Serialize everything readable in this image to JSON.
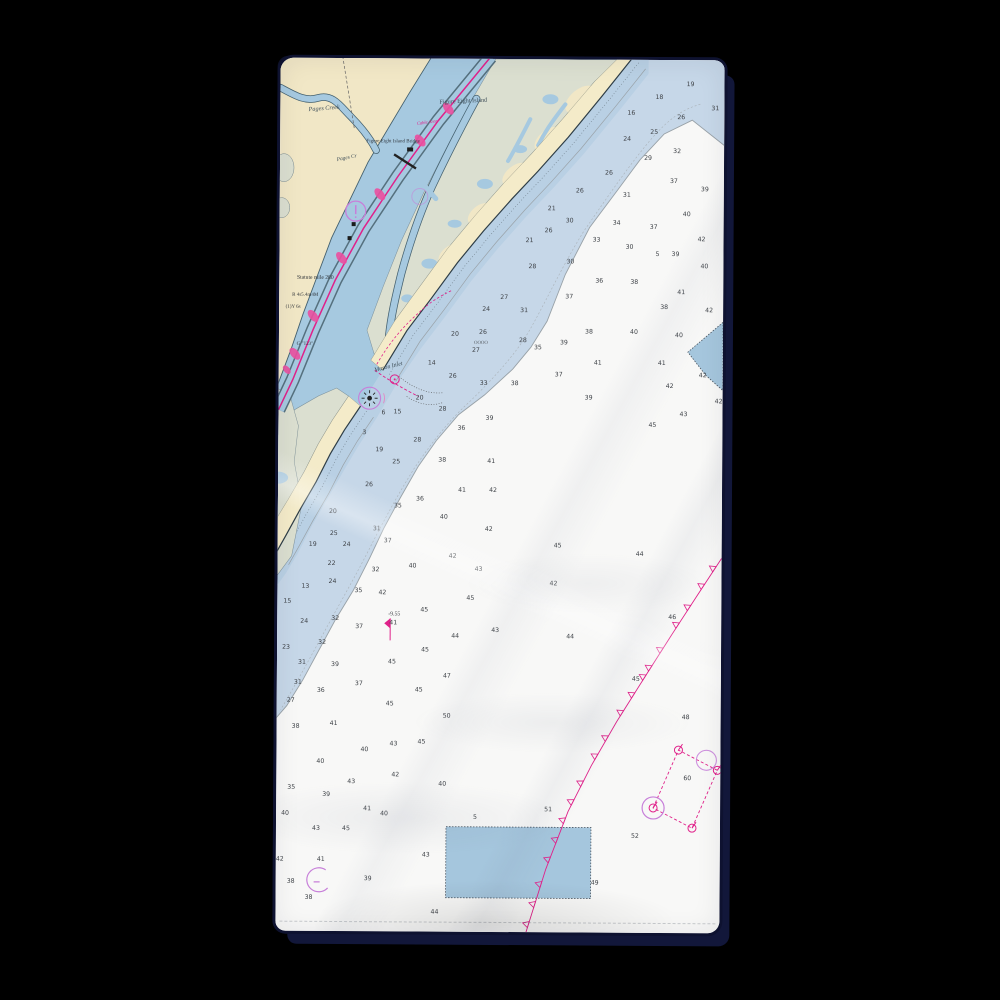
{
  "scene": {
    "type": "product-photo-of-beach-towel-with-nautical-chart-print",
    "background_color": "#000000",
    "towel_color": "#f7f7f8",
    "shadow_color": "#12173a"
  },
  "chart": {
    "colors": {
      "land_tan": "#f1e7c6",
      "beach": "#f4ebc9",
      "marsh_green": "#dbdfd0",
      "channel_blue": "#a6c9e0",
      "shoal_band": "#b9d0e4",
      "nearshore_band": "#c6d7e8",
      "offshore_white": "#f8f8f7",
      "shoreline_dark": "#2e3d46",
      "contour_gray": "#98a1a7",
      "icw_magenta": "#e0218a",
      "caution_purple": "#c77fd9",
      "sounding_text": "#3f4348",
      "disposal_blue": "#a5c6dd"
    },
    "place_labels": [
      {
        "t": "Pages Creek",
        "x": 44,
        "y": 52,
        "s": 6.2,
        "c": "#3e4e58",
        "r": -5,
        "i": 1
      },
      {
        "t": "Figure Eight Island",
        "x": 183,
        "y": 44,
        "s": 6.2,
        "c": "#3e4e58",
        "r": -3,
        "i": 0
      },
      {
        "t": "Figure Eight Island Bridge",
        "x": 113,
        "y": 84,
        "s": 5.0,
        "c": "#333940",
        "r": 0,
        "i": 0
      },
      {
        "t": "Cable Area",
        "x": 147,
        "y": 65,
        "s": 4.6,
        "c": "#e0218a",
        "r": -8,
        "i": 1
      },
      {
        "t": "Pages Cr",
        "x": 67,
        "y": 101,
        "s": 5.4,
        "c": "#3e4e58",
        "r": -12,
        "i": 1
      },
      {
        "t": "Mason Inlet",
        "x": 110,
        "y": 310,
        "s": 6.0,
        "c": "#3e4e58",
        "r": -14,
        "i": 1
      },
      {
        "t": "Statute mile 280",
        "x": 36,
        "y": 221,
        "s": 5.6,
        "c": "#2f3338",
        "r": 0,
        "i": 0
      },
      {
        "t": "R 4s5.4m4M",
        "x": 26,
        "y": 238,
        "s": 5.0,
        "c": "#2f3338",
        "r": 0,
        "i": 0
      },
      {
        "t": "(1)Y 6s",
        "x": 14,
        "y": 250,
        "s": 5.0,
        "c": "#2f3338",
        "r": 0,
        "i": 0
      },
      {
        "t": "G \"123\"",
        "x": 26,
        "y": 287,
        "s": 5.0,
        "c": "#2f3338",
        "r": 0,
        "i": 0
      },
      {
        "t": "-9.55",
        "x": 117,
        "y": 557,
        "s": 5.8,
        "c": "#3f4348",
        "r": 0,
        "i": 0
      },
      {
        "t": "OOOO",
        "x": 202,
        "y": 285,
        "s": 4.8,
        "c": "#555b60",
        "r": 0,
        "i": 0
      }
    ],
    "soundings": [
      [
        410,
        26,
        "19"
      ],
      [
        379,
        39,
        "18"
      ],
      [
        435,
        50,
        "31"
      ],
      [
        351,
        55,
        "16"
      ],
      [
        401,
        59,
        "26"
      ],
      [
        374,
        74,
        "25"
      ],
      [
        347,
        81,
        "24"
      ],
      [
        397,
        93,
        "32"
      ],
      [
        368,
        100,
        "29"
      ],
      [
        329,
        115,
        "26"
      ],
      [
        394,
        123,
        "37"
      ],
      [
        425,
        131,
        "39"
      ],
      [
        300,
        133,
        "26"
      ],
      [
        347,
        137,
        "31"
      ],
      [
        272,
        151,
        "21"
      ],
      [
        407,
        156,
        "40"
      ],
      [
        290,
        163,
        "30"
      ],
      [
        337,
        165,
        "34"
      ],
      [
        374,
        169,
        "37"
      ],
      [
        269,
        173,
        "26"
      ],
      [
        317,
        182,
        "33"
      ],
      [
        250,
        183,
        "21"
      ],
      [
        422,
        181,
        "42"
      ],
      [
        350,
        189,
        "30"
      ],
      [
        378,
        196,
        "5"
      ],
      [
        396,
        196,
        "39"
      ],
      [
        291,
        204,
        "30"
      ],
      [
        253,
        209,
        "28"
      ],
      [
        425,
        208,
        "40"
      ],
      [
        320,
        223,
        "36"
      ],
      [
        355,
        224,
        "38"
      ],
      [
        402,
        234,
        "41"
      ],
      [
        290,
        239,
        "37"
      ],
      [
        225,
        240,
        "27"
      ],
      [
        385,
        249,
        "38"
      ],
      [
        430,
        252,
        "42"
      ],
      [
        207,
        252,
        "24"
      ],
      [
        245,
        253,
        "31"
      ],
      [
        176,
        277,
        "20"
      ],
      [
        204,
        275,
        "26"
      ],
      [
        310,
        274,
        "38"
      ],
      [
        355,
        274,
        "40"
      ],
      [
        400,
        277,
        "40"
      ],
      [
        244,
        283,
        "28"
      ],
      [
        285,
        285,
        "39"
      ],
      [
        259,
        290,
        "35"
      ],
      [
        197,
        293,
        "27"
      ],
      [
        319,
        305,
        "41"
      ],
      [
        153,
        306,
        "14"
      ],
      [
        174,
        319,
        "26"
      ],
      [
        205,
        326,
        "33"
      ],
      [
        280,
        317,
        "37"
      ],
      [
        236,
        326,
        "38"
      ],
      [
        383,
        305,
        "41"
      ],
      [
        424,
        317,
        "42"
      ],
      [
        391,
        328,
        "42"
      ],
      [
        141,
        341,
        "20"
      ],
      [
        310,
        340,
        "39"
      ],
      [
        440,
        343,
        "42"
      ],
      [
        164,
        352,
        "28"
      ],
      [
        119,
        355,
        "15"
      ],
      [
        105,
        356,
        "6"
      ],
      [
        211,
        361,
        "39"
      ],
      [
        183,
        371,
        "36"
      ],
      [
        405,
        356,
        "43"
      ],
      [
        374,
        367,
        "45"
      ],
      [
        86,
        376,
        "3"
      ],
      [
        139,
        383,
        "28"
      ],
      [
        101,
        393,
        "19"
      ],
      [
        118,
        405,
        "25"
      ],
      [
        164,
        403,
        "38"
      ],
      [
        213,
        404,
        "41"
      ],
      [
        91,
        428,
        "26"
      ],
      [
        184,
        433,
        "41"
      ],
      [
        215,
        433,
        "42"
      ],
      [
        142,
        442,
        "36"
      ],
      [
        120,
        449,
        "35"
      ],
      [
        55,
        455,
        "20"
      ],
      [
        166,
        460,
        "40"
      ],
      [
        56,
        477,
        "25"
      ],
      [
        99,
        472,
        "31"
      ],
      [
        211,
        472,
        "42"
      ],
      [
        69,
        488,
        "24"
      ],
      [
        110,
        484,
        "37"
      ],
      [
        35,
        488,
        "19"
      ],
      [
        280,
        488,
        "45"
      ],
      [
        175,
        499,
        "42"
      ],
      [
        362,
        496,
        "44"
      ],
      [
        54,
        507,
        "22"
      ],
      [
        135,
        509,
        "40"
      ],
      [
        201,
        512,
        "43"
      ],
      [
        98,
        513,
        "32"
      ],
      [
        276,
        526,
        "42"
      ],
      [
        55,
        525,
        "24"
      ],
      [
        28,
        530,
        "13"
      ],
      [
        81,
        534,
        "35"
      ],
      [
        105,
        536,
        "42"
      ],
      [
        193,
        541,
        "45"
      ],
      [
        10,
        545,
        "15"
      ],
      [
        147,
        553,
        "45"
      ],
      [
        395,
        559,
        "46"
      ],
      [
        116,
        566,
        "41"
      ],
      [
        27,
        565,
        "24"
      ],
      [
        58,
        562,
        "32"
      ],
      [
        82,
        570,
        "37"
      ],
      [
        178,
        579,
        "44"
      ],
      [
        218,
        573,
        "43"
      ],
      [
        45,
        586,
        "32"
      ],
      [
        9,
        591,
        "23"
      ],
      [
        148,
        593,
        "45"
      ],
      [
        293,
        579,
        "44"
      ],
      [
        25,
        606,
        "31"
      ],
      [
        115,
        605,
        "45"
      ],
      [
        58,
        608,
        "39"
      ],
      [
        359,
        621,
        "45"
      ],
      [
        170,
        619,
        "47"
      ],
      [
        21,
        626,
        "31"
      ],
      [
        82,
        627,
        "37"
      ],
      [
        44,
        634,
        "36"
      ],
      [
        142,
        633,
        "45"
      ],
      [
        14,
        644,
        "27"
      ],
      [
        113,
        647,
        "45"
      ],
      [
        170,
        659,
        "50"
      ],
      [
        409,
        659,
        "48"
      ],
      [
        19,
        670,
        "38"
      ],
      [
        57,
        667,
        "41"
      ],
      [
        117,
        687,
        "43"
      ],
      [
        145,
        685,
        "45"
      ],
      [
        88,
        693,
        "40"
      ],
      [
        44,
        705,
        "40"
      ],
      [
        411,
        720,
        "60"
      ],
      [
        119,
        718,
        "42"
      ],
      [
        75,
        725,
        "43"
      ],
      [
        166,
        727,
        "40"
      ],
      [
        15,
        731,
        "35"
      ],
      [
        50,
        738,
        "39"
      ],
      [
        272,
        752,
        "51"
      ],
      [
        91,
        752,
        "41"
      ],
      [
        108,
        757,
        "40"
      ],
      [
        9,
        757,
        "40"
      ],
      [
        199,
        760,
        "5"
      ],
      [
        40,
        772,
        "43"
      ],
      [
        70,
        772,
        "45"
      ],
      [
        359,
        778,
        "52"
      ],
      [
        150,
        798,
        "43"
      ],
      [
        4,
        803,
        "42"
      ],
      [
        45,
        803,
        "41"
      ],
      [
        319,
        825,
        "49"
      ],
      [
        15,
        825,
        "38"
      ],
      [
        92,
        822,
        "39"
      ],
      [
        33,
        841,
        "38"
      ],
      [
        159,
        855,
        "44"
      ]
    ],
    "cable_area_line": {
      "points": [
        [
          250,
          875
        ],
        [
          270,
          810
        ],
        [
          292,
          752
        ],
        [
          315,
          706
        ],
        [
          340,
          662
        ],
        [
          368,
          617
        ],
        [
          395,
          574
        ],
        [
          420,
          535
        ],
        [
          444,
          498
        ]
      ],
      "color": "#e0218a"
    }
  }
}
